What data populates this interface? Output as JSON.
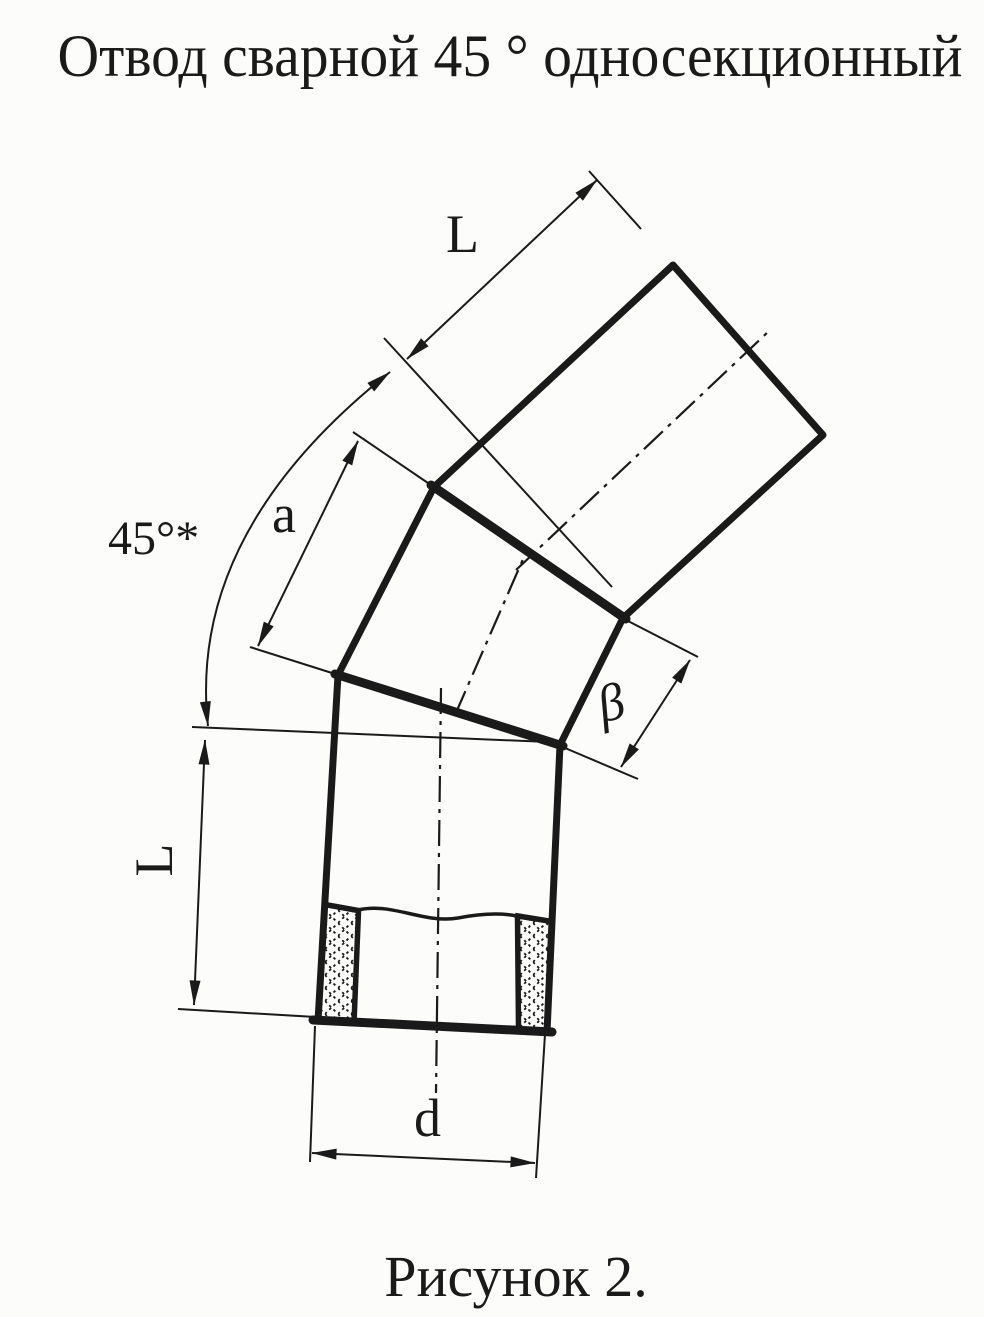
{
  "page": {
    "background_color": "#fcfcfa",
    "ink_color": "#1a1a1a",
    "title": "Отвод сварной 45 ° односекционный",
    "caption": "Рисунок 2."
  },
  "drawing": {
    "kind": "technical-drawing",
    "subject": "Welded 45-degree single-section pipe elbow, scanned line drawing with dimension callouts",
    "dimension_labels": {
      "top_segment_length": "L",
      "bottom_segment_length": "L",
      "middle_section_outer_edge": "a",
      "bend_angle": "45°*",
      "middle_section_inner_edge": "β",
      "pipe_diameter": "d"
    }
  }
}
